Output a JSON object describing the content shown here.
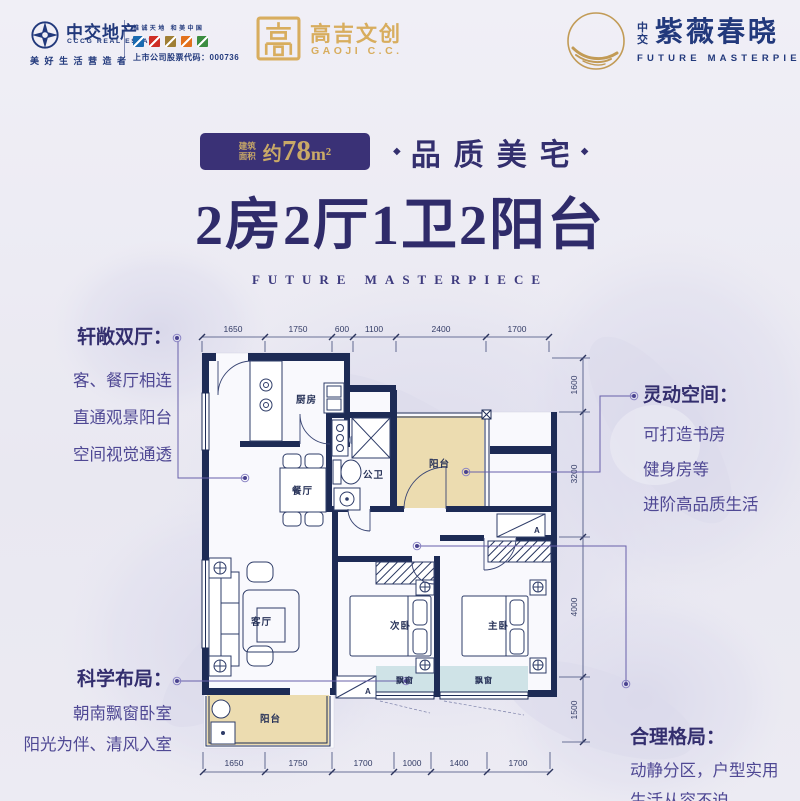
{
  "header": {
    "cccg": {
      "name": "中交地产",
      "name_en": "CCCG REAL ESTATE",
      "slogan": "美好生活营造者",
      "tagline": "推诚天地 和美中国",
      "stock": "上市公司股票代码：000736"
    },
    "gaoji": {
      "name": "高吉文创",
      "name_en": "GAOJI C.C."
    },
    "brand": {
      "prefix": "中交",
      "name": "紫薇春晓",
      "name_en": "FUTURE MASTERPIECE"
    }
  },
  "title": {
    "area_label_1": "建筑",
    "area_label_2": "面积",
    "area_prefix": "约",
    "area_num": "78",
    "area_unit": "m²",
    "diamond": "◆",
    "quality": "品质美宅",
    "main": "2房2厅1卫2阳台",
    "divider": "FUTURE MASTERPIECE"
  },
  "callouts": {
    "lt": {
      "heading": "轩敞双厅：",
      "lines": [
        "客、餐厅相连",
        "直通观景阳台",
        "空间视觉通透"
      ]
    },
    "rt": {
      "heading": "灵动空间：",
      "lines": [
        "可打造书房",
        "健身房等",
        "进阶高品质生活"
      ]
    },
    "lb": {
      "heading": "科学布局：",
      "lines": [
        "朝南飘窗卧室",
        "阳光为伴、清风入室"
      ]
    },
    "rb": {
      "heading": "合理格局：",
      "lines": [
        "动静分区，户型实用",
        "生活从容不迫"
      ]
    }
  },
  "floorplan": {
    "rooms": {
      "kitchen": "厨房",
      "dining": "餐厅",
      "bath": "公卫",
      "balcony_top": "阳台",
      "living": "客厅",
      "bed2": "次卧",
      "bed1": "主卧",
      "bay1": "飘窗",
      "bay2": "飘窗",
      "balcony_bottom": "阳台",
      "ac_label": "A"
    },
    "dims_top": [
      "1650",
      "1750",
      "600",
      "1100",
      "2400",
      "1700"
    ],
    "dims_bottom": [
      "1650",
      "1750",
      "1700",
      "1000",
      "1400",
      "1700"
    ],
    "dims_right": [
      "1600",
      "3200",
      "4000",
      "1500"
    ]
  },
  "icons": {
    "cccg_logo": "compass-rose-icon",
    "gaoji_logo": "seal-square-icon",
    "brand_logo": "gold-moon-brush-icon",
    "bullet": "diamond-icon"
  },
  "colors": {
    "navy": "#22397c",
    "purple": "#332f6e",
    "purple_text": "#4f4894",
    "gold": "#c9a967",
    "gold_logo": "#d8ad5e",
    "badge_bg": "#3a3176",
    "wall": "#1d2b55",
    "balcony_fill": "#ecdcb0",
    "bay_fill": "#cfe3e7",
    "background": "#f0eff6",
    "brand_squares": [
      "#1a6ab0",
      "#cf2e26",
      "#a07f35",
      "#e2711d",
      "#3c8d41"
    ]
  }
}
